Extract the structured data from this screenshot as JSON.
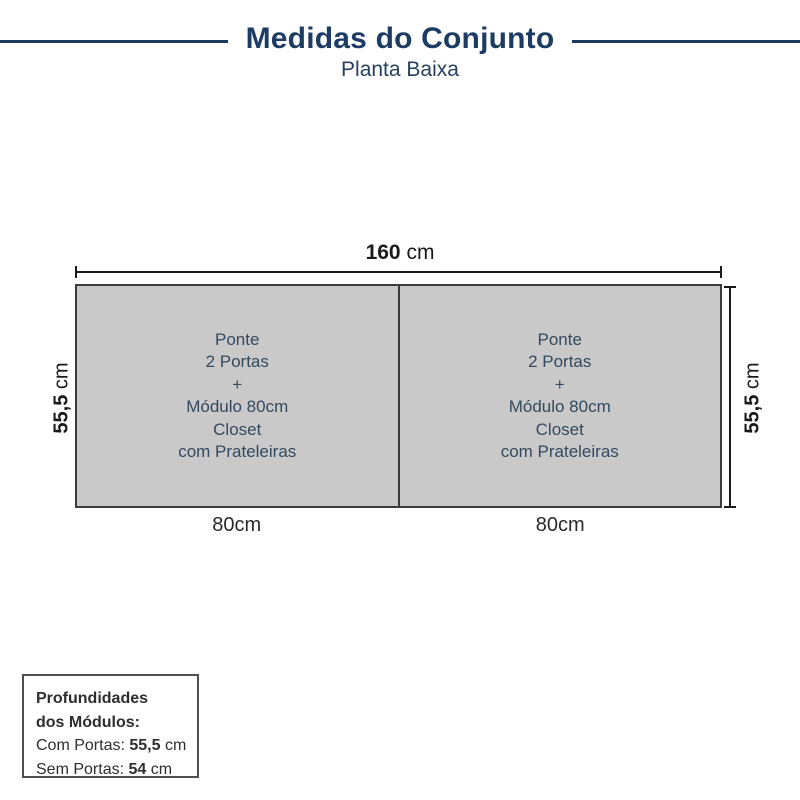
{
  "header": {
    "title": "Medidas do Conjunto",
    "subtitle": "Planta Baixa"
  },
  "plan": {
    "total_width": {
      "value": "160",
      "unit": " cm"
    },
    "depth_left": {
      "value": "55,5",
      "unit": " cm"
    },
    "depth_right": {
      "value": "55,5",
      "unit": " cm"
    },
    "modules": [
      {
        "lines": [
          "Ponte",
          "2 Portas",
          "+",
          "Módulo 80cm",
          "Closet",
          "com Prateleiras"
        ],
        "width_label": "80cm"
      },
      {
        "lines": [
          "Ponte",
          "2 Portas",
          "+",
          "Módulo 80cm",
          "Closet",
          "com Prateleiras"
        ],
        "width_label": "80cm"
      }
    ]
  },
  "info_box": {
    "heading_line1": "Profundidades",
    "heading_line2": "dos Módulos:",
    "rows": [
      {
        "label": "Com Portas: ",
        "value": "55,5",
        "unit": " cm"
      },
      {
        "label": "Sem Portas: ",
        "value": "54",
        "unit": " cm"
      }
    ]
  },
  "colors": {
    "navy": "#1d3c63",
    "module_text": "#34495e",
    "cabinet_fill": "#c9c9c9",
    "line_dark": "#3b3b3b"
  }
}
